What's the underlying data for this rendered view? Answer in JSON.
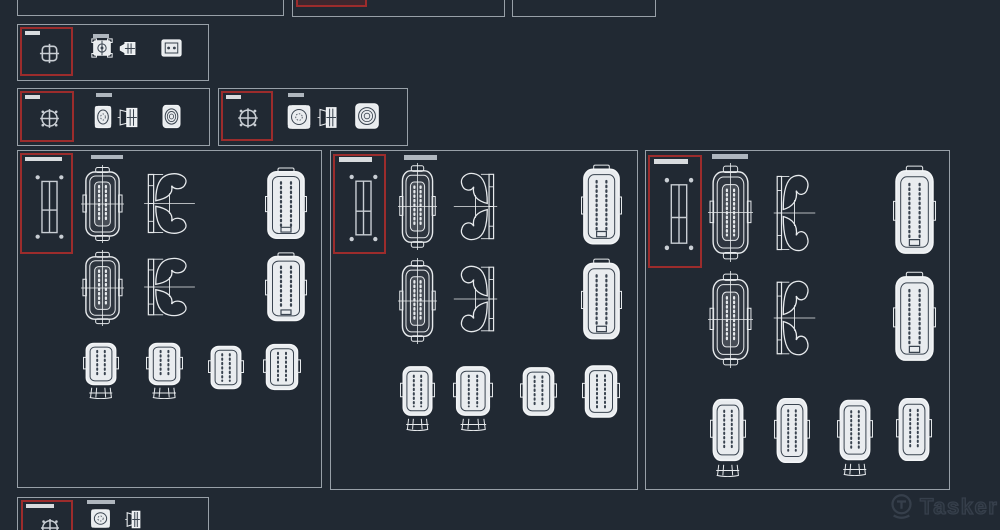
{
  "app": {
    "description": "CAD dark-theme block-library preview grid of electrical connector technical drawings",
    "background": "#212933"
  },
  "colors": {
    "background": "#212933",
    "panel_border": "#98A0A8",
    "selection_red": "#9C2C2C",
    "drawing_ink": "#E7EAED",
    "drawing_body_fill": "#E9ECEF",
    "drawing_dark_detail": "#39434F",
    "label_bright": "#D8DBDE",
    "label_dim": "#AFB6BE",
    "watermark": "#39424E"
  },
  "watermark": {
    "icon": "tasker-logo-icon",
    "label": "Tasker"
  },
  "panels": [
    {
      "id": "top-partial-left",
      "thumbnails": []
    },
    {
      "id": "top-partial-middle",
      "selected_symbol": "selection-red-box",
      "thumbnails": []
    },
    {
      "id": "top-partial-right",
      "thumbnails": []
    },
    {
      "id": "connector-group-a",
      "selected_symbol": "grid-square-block-icon",
      "thumbnails": [
        "connector-front-view",
        "connector-side-view",
        "connector-back-view"
      ]
    },
    {
      "id": "connector-group-b",
      "selected_symbol": "circle-target-block-icon",
      "thumbnails": [
        "round-connector-front-view",
        "round-connector-side-view",
        "round-connector-back-view"
      ]
    },
    {
      "id": "connector-group-c",
      "selected_symbol": "circle-target-block-icon",
      "thumbnails": [
        "round-connector-front-view",
        "round-connector-side-view",
        "round-connector-back-view"
      ]
    },
    {
      "id": "connector-family-1",
      "selected_symbol": "rect-2col-block-icon",
      "thumbnails": [
        "housing-top-view",
        "lock-side-profile",
        "housing-rear-view",
        "housing-top-view",
        "lock-side-profile",
        "housing-rear-view",
        "housing-with-stand",
        "housing-with-stand",
        "housing-small",
        "housing-small"
      ]
    },
    {
      "id": "connector-family-2",
      "selected_symbol": "rect-2col-block-icon",
      "thumbnails": [
        "housing-top-view",
        "lock-side-profile",
        "housing-rear-view",
        "housing-top-view",
        "lock-side-profile",
        "housing-rear-view",
        "housing-with-stand",
        "housing-with-stand",
        "housing-small",
        "housing-small"
      ]
    },
    {
      "id": "connector-family-3",
      "selected_symbol": "rect-2col-block-icon",
      "thumbnails": [
        "housing-top-view",
        "lock-side-profile",
        "housing-rear-view",
        "housing-top-view",
        "lock-side-profile",
        "housing-rear-view",
        "housing-with-stand",
        "housing-small",
        "housing-with-stand",
        "housing-small"
      ]
    },
    {
      "id": "connector-group-d-partial",
      "selected_symbol": "circle-target-block-icon",
      "thumbnails": [
        "round-connector-front-view",
        "round-connector-side-view"
      ]
    }
  ]
}
